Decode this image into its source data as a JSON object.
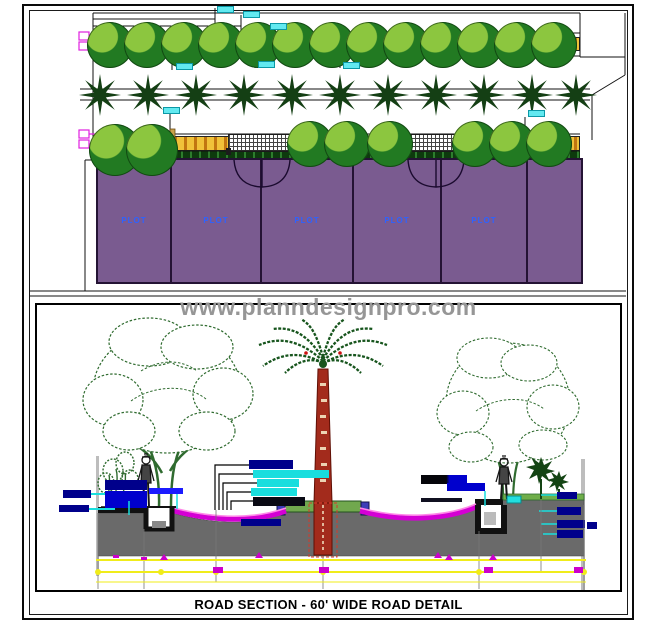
{
  "page": {
    "watermark": "www.planndesignpro.com",
    "title": "ROAD SECTION - 60' WIDE ROAD DETAIL"
  },
  "plan": {
    "plots": [
      {
        "label": "PLOT"
      },
      {
        "label": "PLOT"
      },
      {
        "label": "PLOT"
      },
      {
        "label": "PLOT"
      },
      {
        "label": "PLOT"
      },
      {
        "label": ""
      }
    ]
  },
  "colors": {
    "plot_fill": "#7a5b90",
    "plot_label_blue": "#2e62ff",
    "footpath_yellow": "#f0c23a",
    "tree_dark_green": "#227a22",
    "tree_light_green": "#8cc63f",
    "palm_star_green": "#143f14",
    "road_gray": "#6a6a6a",
    "road_surface_magenta": "#d400d4",
    "median_green": "#71a84e",
    "palm_trunk_red": "#a32b1c",
    "label_navy": "#00008b",
    "label_cyan": "#19dede",
    "dimension_yellow": "#f0ec1a",
    "watermark_gray": "#969696"
  }
}
